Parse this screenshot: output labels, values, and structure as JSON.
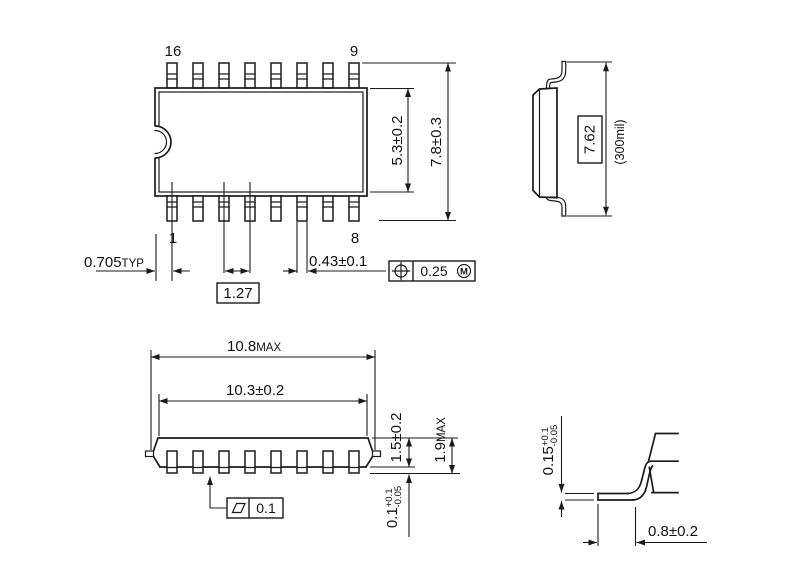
{
  "top_view": {
    "pin_labels": {
      "p16": "16",
      "p9": "9",
      "p1": "1",
      "p8": "8"
    },
    "dims": {
      "lead_offset_value": "0.705",
      "lead_offset_suffix": "TYP",
      "pitch": "1.27",
      "lead_width": "0.43±0.1",
      "body_width": "5.3±0.2",
      "lead_span": "7.8±0.3",
      "position_tolerance": "0.25",
      "position_modifier": "M"
    }
  },
  "end_view": {
    "dims": {
      "lead_span_boxed": "7.62",
      "lead_span_note": "(300mil)"
    }
  },
  "front_view": {
    "dims": {
      "overall_length_value": "10.8",
      "overall_length_suffix": "MAX",
      "body_length": "10.3±0.2",
      "body_thickness": "1.5±0.2",
      "overall_height_value": "1.9",
      "overall_height_suffix": "MAX",
      "standoff_value": "0.1",
      "standoff_plus": "+0.1",
      "standoff_minus": "-0.05",
      "coplanarity": "0.1"
    }
  },
  "lead_detail": {
    "dims": {
      "thickness_value": "0.15",
      "thickness_plus": "+0.1",
      "thickness_minus": "-0.05",
      "foot_length": "0.8±0.2"
    }
  }
}
